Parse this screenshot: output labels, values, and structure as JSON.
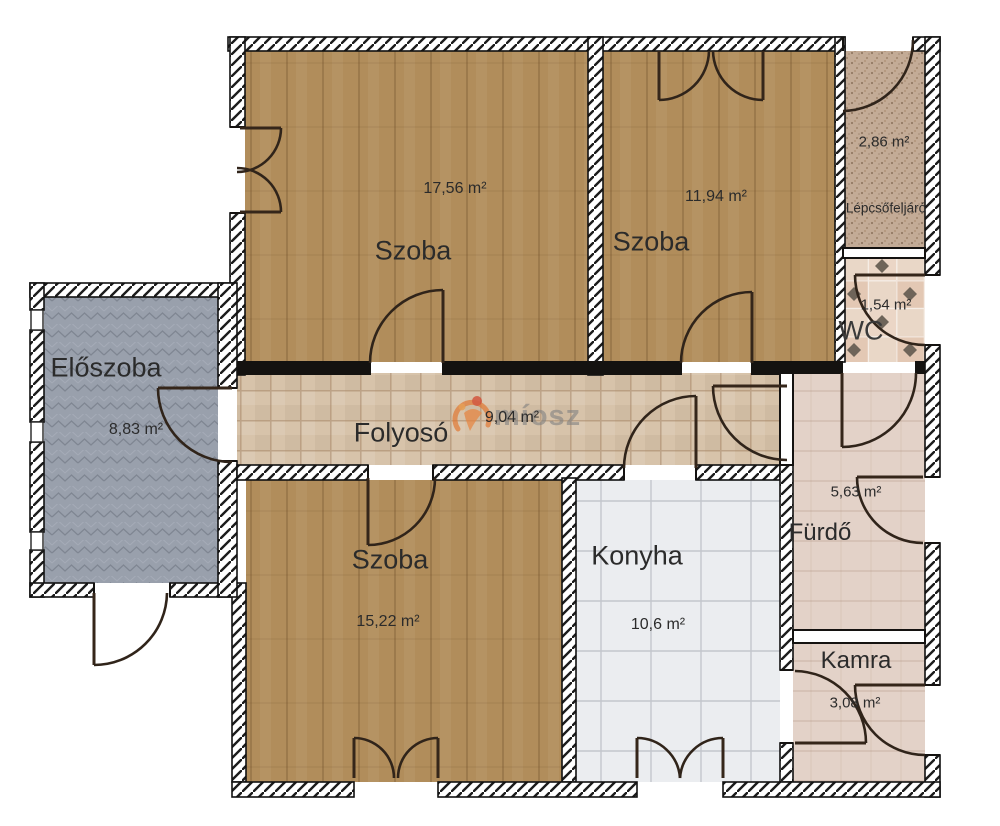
{
  "title": "Apartment floor plan",
  "watermark": {
    "text": "míosz"
  },
  "rooms": [
    {
      "id": "szoba-top-left",
      "name": "Szoba",
      "area": "17,56 m²"
    },
    {
      "id": "szoba-top-right",
      "name": "Szoba",
      "area": "11,94 m²"
    },
    {
      "id": "lepcsofeljaro",
      "name": "Lépcsőfeljáró",
      "area": "2,86 m²"
    },
    {
      "id": "wc",
      "name": "WC",
      "area": "1,54 m²"
    },
    {
      "id": "eloszoba",
      "name": "Előszoba",
      "area": "8,83 m²"
    },
    {
      "id": "folyoso",
      "name": "Folyosó",
      "area": "9,04 m²"
    },
    {
      "id": "szoba-bottom",
      "name": "Szoba",
      "area": "15,22 m²"
    },
    {
      "id": "konyha",
      "name": "Konyha",
      "area": "10,6 m²"
    },
    {
      "id": "furdo",
      "name": "Fürdő",
      "area": "5,63 m²"
    },
    {
      "id": "kamra",
      "name": "Kamra",
      "area": "3,08 m²"
    }
  ],
  "colors": {
    "wood_floor": "#b18d5b",
    "hall_gray": "#99a0ac",
    "corridor_tile": "#d7c3aa",
    "kitchen_tile": "#ebedf0",
    "bath_tile": "#e3d2c8",
    "stairs_carpet": "#c3ab96",
    "wc_diamond": "#6e6459",
    "wall_dark": "#141210",
    "watermark_orange": "#e0762f"
  }
}
